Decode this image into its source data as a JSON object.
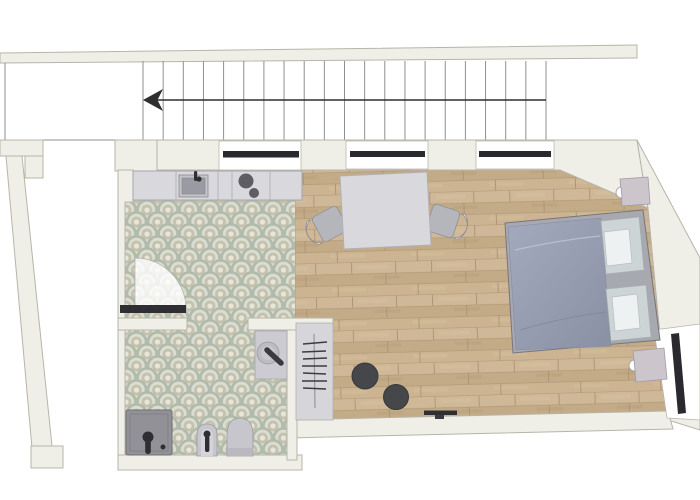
{
  "meta": {
    "view": "studio-apartment-floor-plan",
    "description": "Top-down architectural floor plan: staircase above, open kitchen with tiled floor, bathroom with patterned tile, combined living/bedroom with wood floor"
  },
  "colors": {
    "wall": "#f0efe7",
    "wallStroke": "#b7b5aa",
    "stairLine": "#8f8f8d",
    "arrow": "#2e2e2e",
    "windowGlass": "#2a2a2e",
    "woodBase": "#c9b190",
    "woodDark": "#c3ab88",
    "woodLight": "#cfb897",
    "tileBg": "#ecede3",
    "tileRing": "#b2bbab",
    "tileLight": "#d9ded1",
    "tileCenter": "#c6c1ad",
    "tileDot": "#e4e6da",
    "furnGray": "#d9d9dd",
    "fixtureDark": "#2f2f33",
    "bedFrame": "#a8a8b0",
    "duvetA": "#a2a8bc",
    "duvetB": "#8c92a6",
    "pillow": "#ccd4d6",
    "pouf": "#45474b"
  },
  "stairs": {
    "tread_start_x": 143,
    "tread_end_x": 546,
    "tread_step": 20.15,
    "tread_top_y": 61,
    "tread_bottom_y": 141,
    "arrow_y": 100,
    "direction": "down-to-left"
  },
  "rooms": [
    {
      "name": "kitchen",
      "floor": "scallop-tile"
    },
    {
      "name": "bathroom",
      "floor": "scallop-tile"
    },
    {
      "name": "living-bedroom",
      "floor": "wood-plank"
    }
  ],
  "windows": [
    {
      "name": "window-top-1"
    },
    {
      "name": "window-top-2"
    },
    {
      "name": "window-top-3"
    },
    {
      "name": "window-right"
    }
  ],
  "fixtures": [
    "kitchen-counter",
    "kitchen-sink",
    "cooktop",
    "dining-table",
    "chair-left",
    "chair-right",
    "double-bed",
    "nightstand-top",
    "nightstand-bottom",
    "pouf-1",
    "pouf-2",
    "clothes-rack",
    "tv",
    "shower",
    "bidet",
    "toilet",
    "washbasin",
    "bathroom-door"
  ]
}
